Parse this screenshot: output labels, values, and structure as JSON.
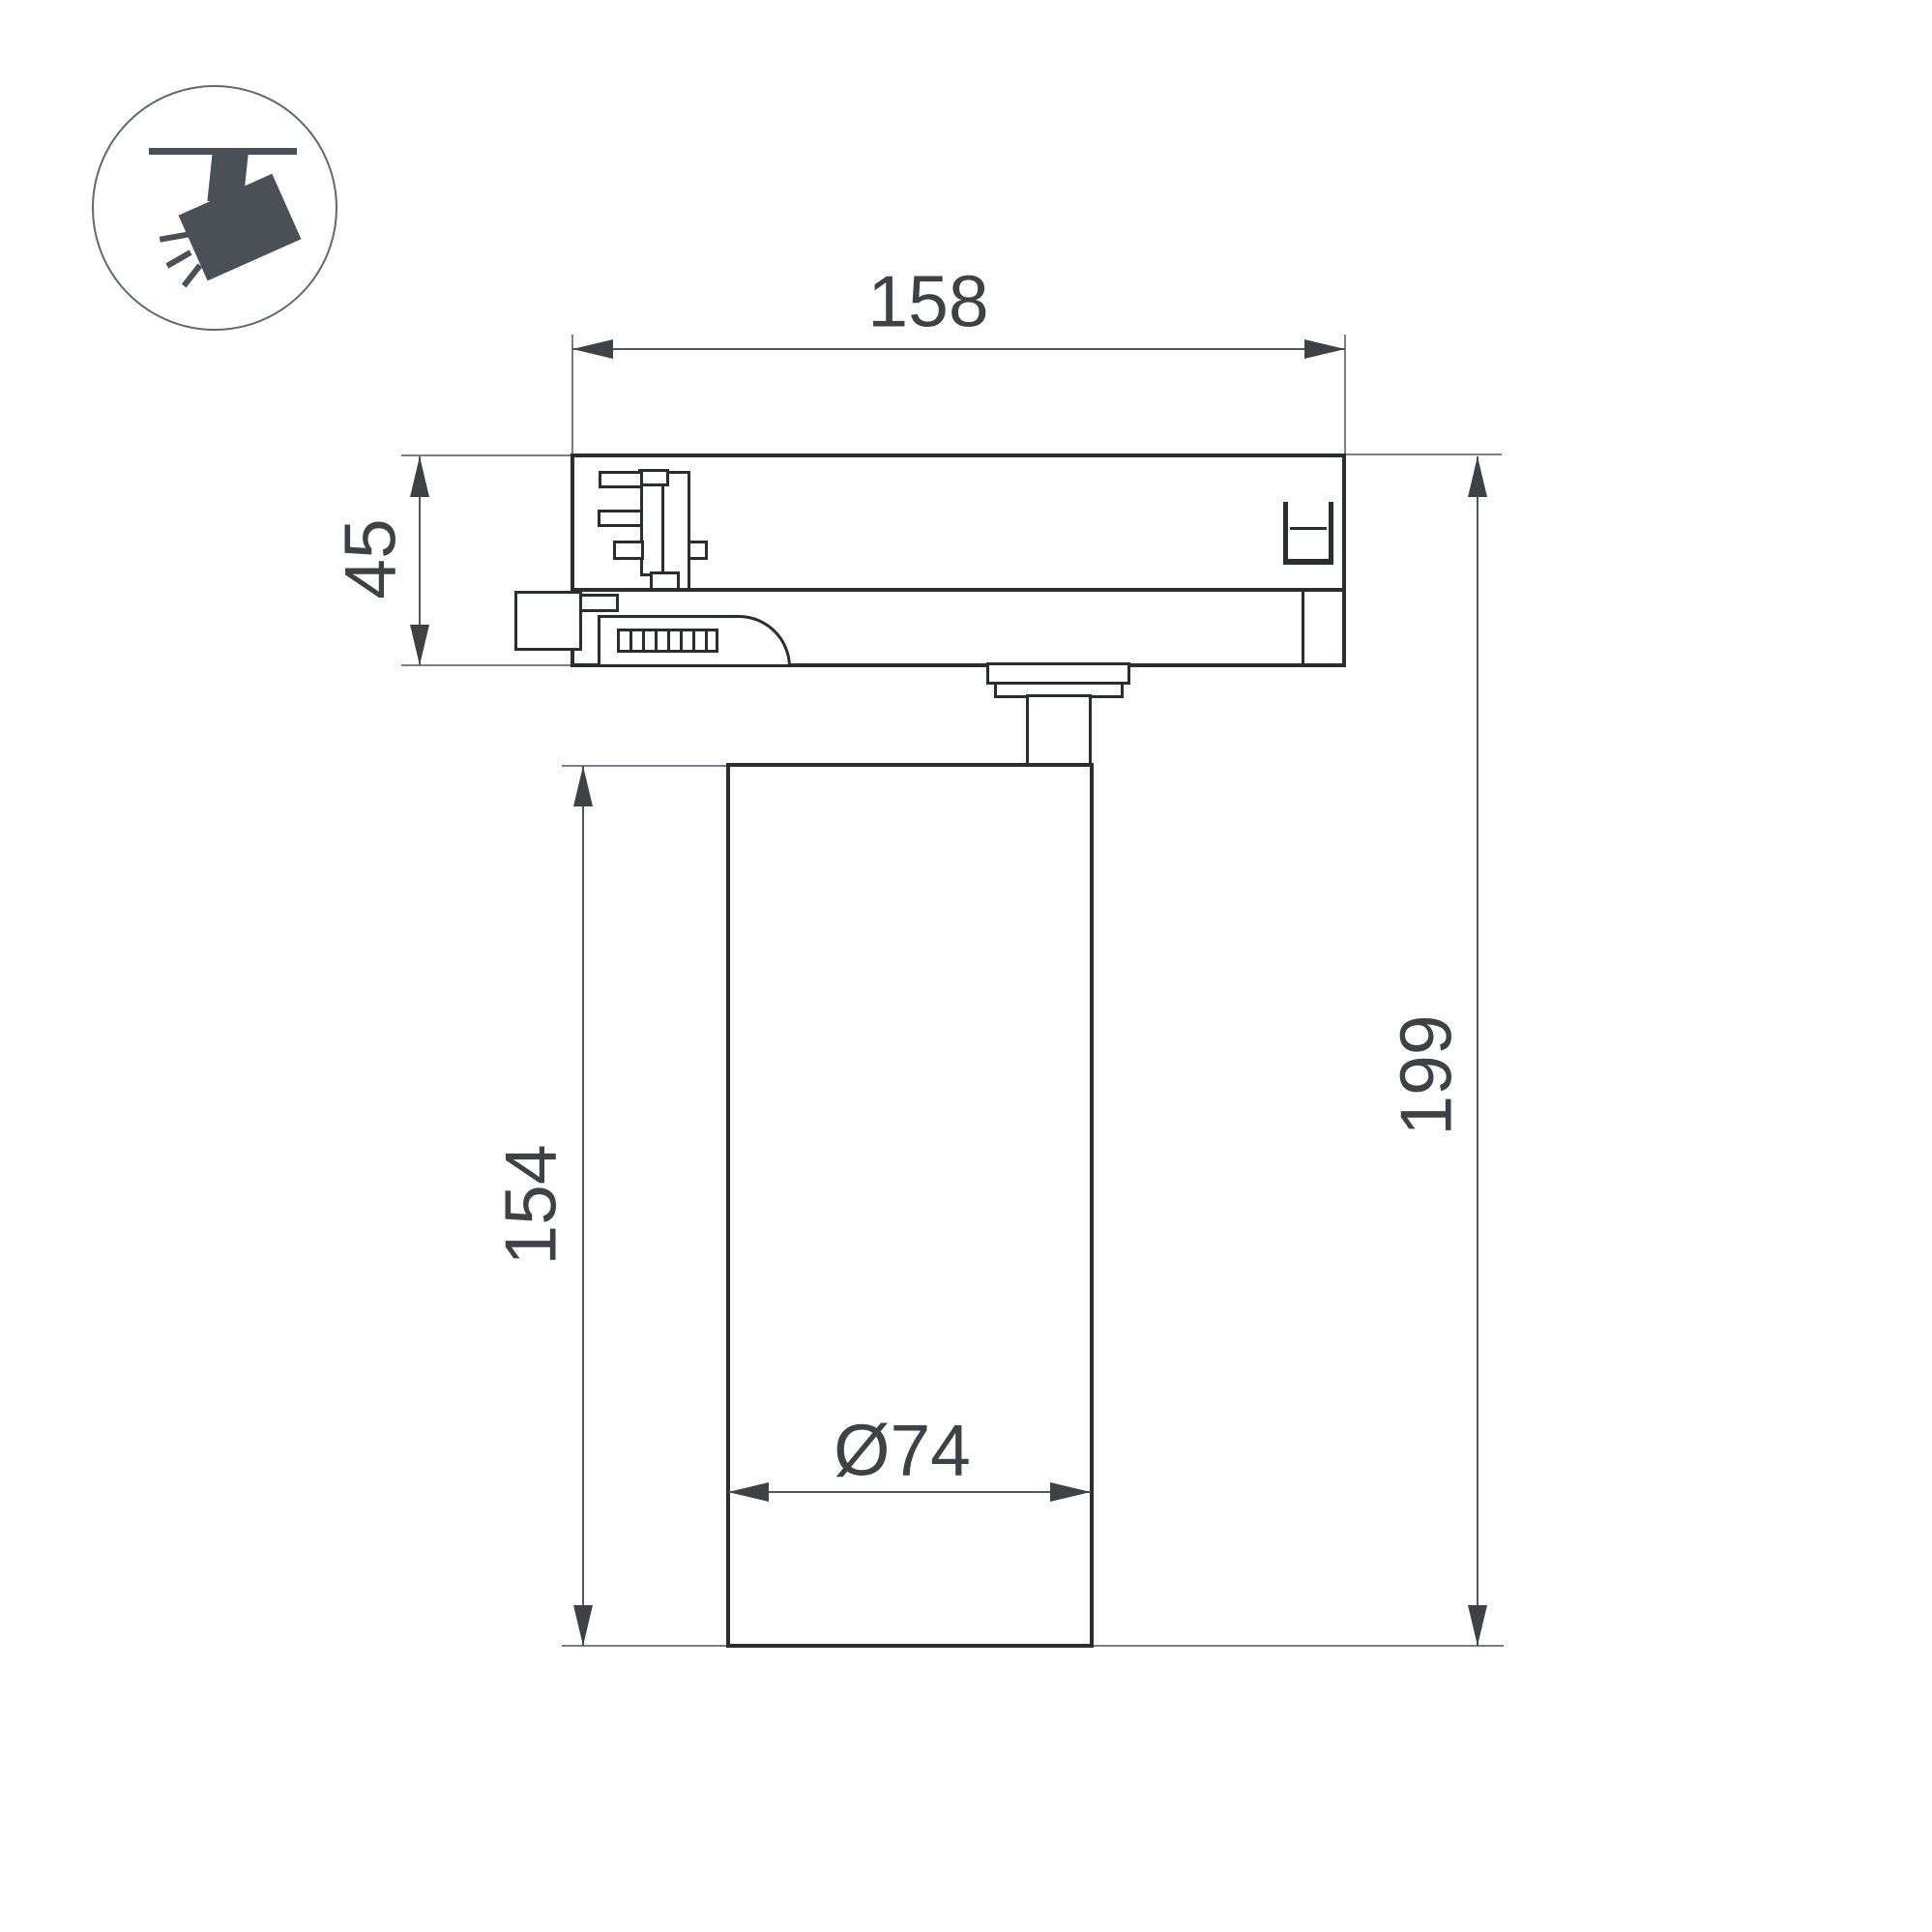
{
  "icon": {
    "name": "track-spotlight",
    "color": "#495056"
  },
  "dimensions": {
    "track_width": "158",
    "adapter_height": "45",
    "body_height": "154",
    "total_height": "199",
    "body_diameter": "Ø74"
  },
  "colors": {
    "background": "#ffffff",
    "outline": "#2c2d2f",
    "dimension_line": "#55575c",
    "extension_line": "#7b7d82",
    "label_text": "#3f4145",
    "icon": "#495056"
  }
}
